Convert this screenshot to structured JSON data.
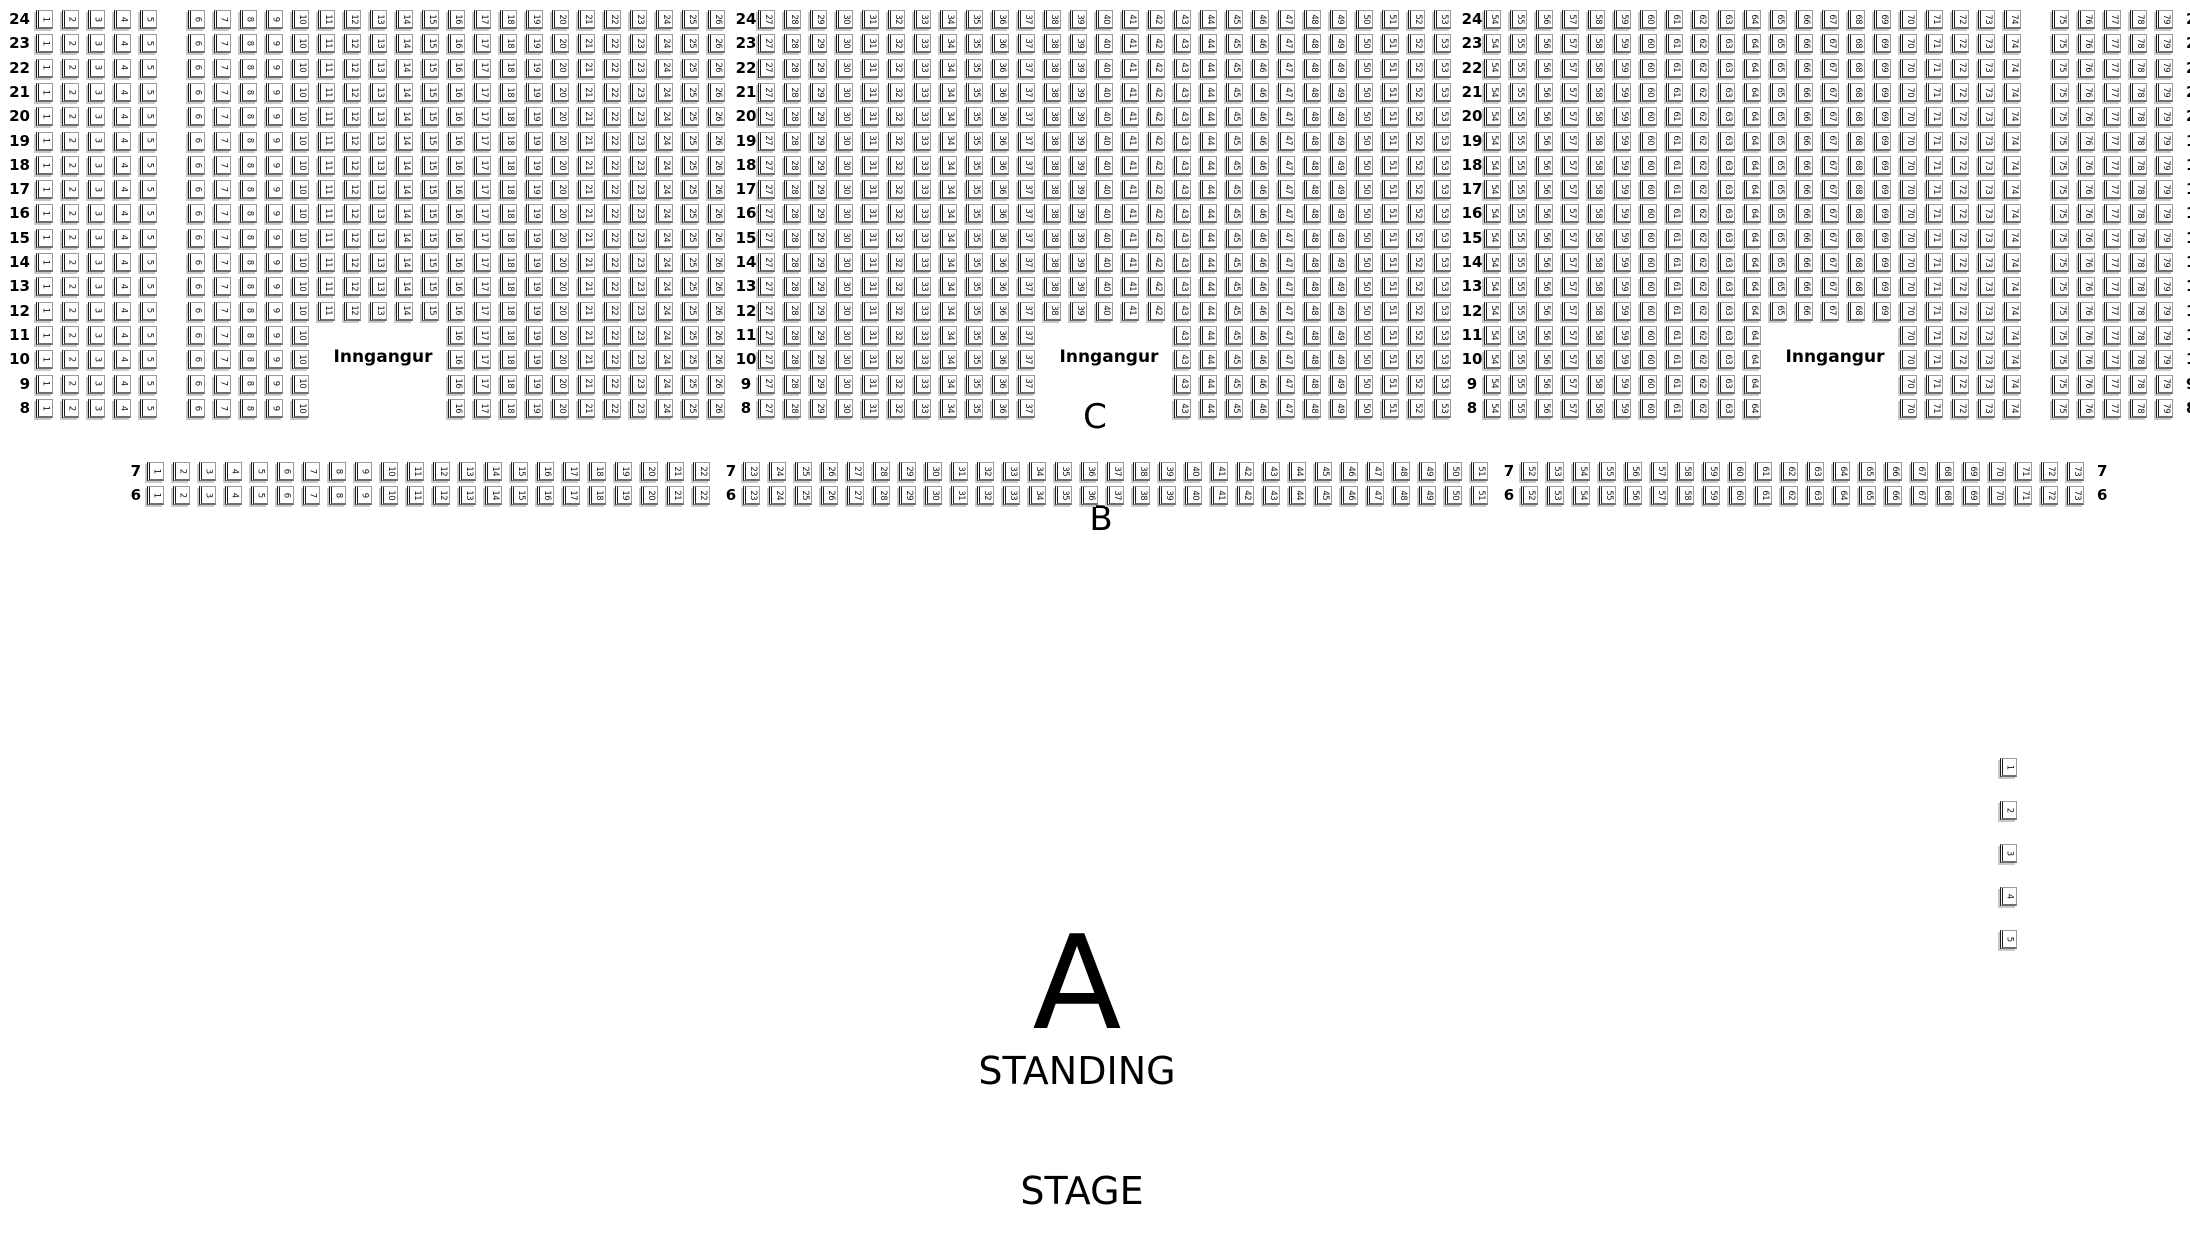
{
  "labels": {
    "entrance": "Inngangur",
    "section_a": "A",
    "standing": "STANDING",
    "stage": "STAGE",
    "section_b": "B",
    "section_c": "C"
  },
  "colors": {
    "background": "#ffffff",
    "text": "#000000",
    "seat_border": "#9a9a9a",
    "seat_accent": "#1d1d1d",
    "seat_shadow": "#c9c9c9"
  },
  "seat_map": {
    "upper_rows": [
      {
        "label": "24",
        "gapped": false
      },
      {
        "label": "23",
        "gapped": false
      },
      {
        "label": "22",
        "gapped": false
      },
      {
        "label": "21",
        "gapped": false
      },
      {
        "label": "20",
        "gapped": false
      },
      {
        "label": "19",
        "gapped": false
      },
      {
        "label": "18",
        "gapped": false
      },
      {
        "label": "17",
        "gapped": false
      },
      {
        "label": "16",
        "gapped": false
      },
      {
        "label": "15",
        "gapped": false
      },
      {
        "label": "14",
        "gapped": false
      },
      {
        "label": "13",
        "gapped": false
      },
      {
        "label": "12",
        "gapped": false
      },
      {
        "label": "11",
        "gapped": true
      },
      {
        "label": "10",
        "gapped": true
      },
      {
        "label": "9",
        "gapped": true
      },
      {
        "label": "8",
        "gapped": true
      }
    ],
    "segments_full": [
      {
        "type": "rowlabel",
        "side": "left"
      },
      {
        "type": "seats",
        "from": 1,
        "to": 5
      },
      {
        "type": "aisle"
      },
      {
        "type": "seats",
        "from": 6,
        "to": 26
      },
      {
        "type": "rowlabel"
      },
      {
        "type": "seats",
        "from": 27,
        "to": 53
      },
      {
        "type": "rowlabel"
      },
      {
        "type": "seats",
        "from": 54,
        "to": 74
      },
      {
        "type": "aisle"
      },
      {
        "type": "seats",
        "from": 75,
        "to": 79
      },
      {
        "type": "rowlabel",
        "side": "right"
      }
    ],
    "segments_gapped": [
      {
        "type": "rowlabel",
        "side": "left"
      },
      {
        "type": "seats",
        "from": 1,
        "to": 5
      },
      {
        "type": "aisle"
      },
      {
        "type": "seats",
        "from": 6,
        "to": 10
      },
      {
        "type": "entrance"
      },
      {
        "type": "seats",
        "from": 16,
        "to": 26
      },
      {
        "type": "rowlabel"
      },
      {
        "type": "seats",
        "from": 27,
        "to": 37
      },
      {
        "type": "entrance"
      },
      {
        "type": "seats",
        "from": 43,
        "to": 53
      },
      {
        "type": "rowlabel"
      },
      {
        "type": "seats",
        "from": 54,
        "to": 64
      },
      {
        "type": "entrance"
      },
      {
        "type": "seats",
        "from": 70,
        "to": 74
      },
      {
        "type": "aisle"
      },
      {
        "type": "seats",
        "from": 75,
        "to": 79
      },
      {
        "type": "rowlabel",
        "side": "right"
      }
    ],
    "b_rows": [
      "7",
      "6"
    ],
    "b_segments": [
      {
        "type": "indent"
      },
      {
        "type": "rowlabel",
        "side": "left"
      },
      {
        "type": "seats",
        "from": 1,
        "to": 22
      },
      {
        "type": "rowlabel"
      },
      {
        "type": "seats",
        "from": 23,
        "to": 51
      },
      {
        "type": "rowlabel"
      },
      {
        "type": "seats",
        "from": 52,
        "to": 73
      },
      {
        "type": "rowlabel",
        "side": "right"
      }
    ],
    "side_seats": [
      "1",
      "2",
      "3",
      "4",
      "5"
    ],
    "layout": {
      "upper_top": 10,
      "row_pitch": 24.3,
      "b_top": 462,
      "side_left": 2000,
      "side_top": 758,
      "side_pitch": 43
    }
  },
  "overlays": {
    "entrance_left": {
      "x": 383,
      "y": 349
    },
    "entrance_mid": {
      "x": 1109,
      "y": 349
    },
    "entrance_right": {
      "x": 1835,
      "y": 349
    },
    "section_c": {
      "x": 1095,
      "y": 400
    },
    "section_b": {
      "x": 1101,
      "y": 502
    },
    "section_a": {
      "x": 1077,
      "y": 918
    },
    "standing": {
      "x": 1077,
      "y": 1052
    },
    "stage": {
      "x": 1082,
      "y": 1172
    }
  }
}
